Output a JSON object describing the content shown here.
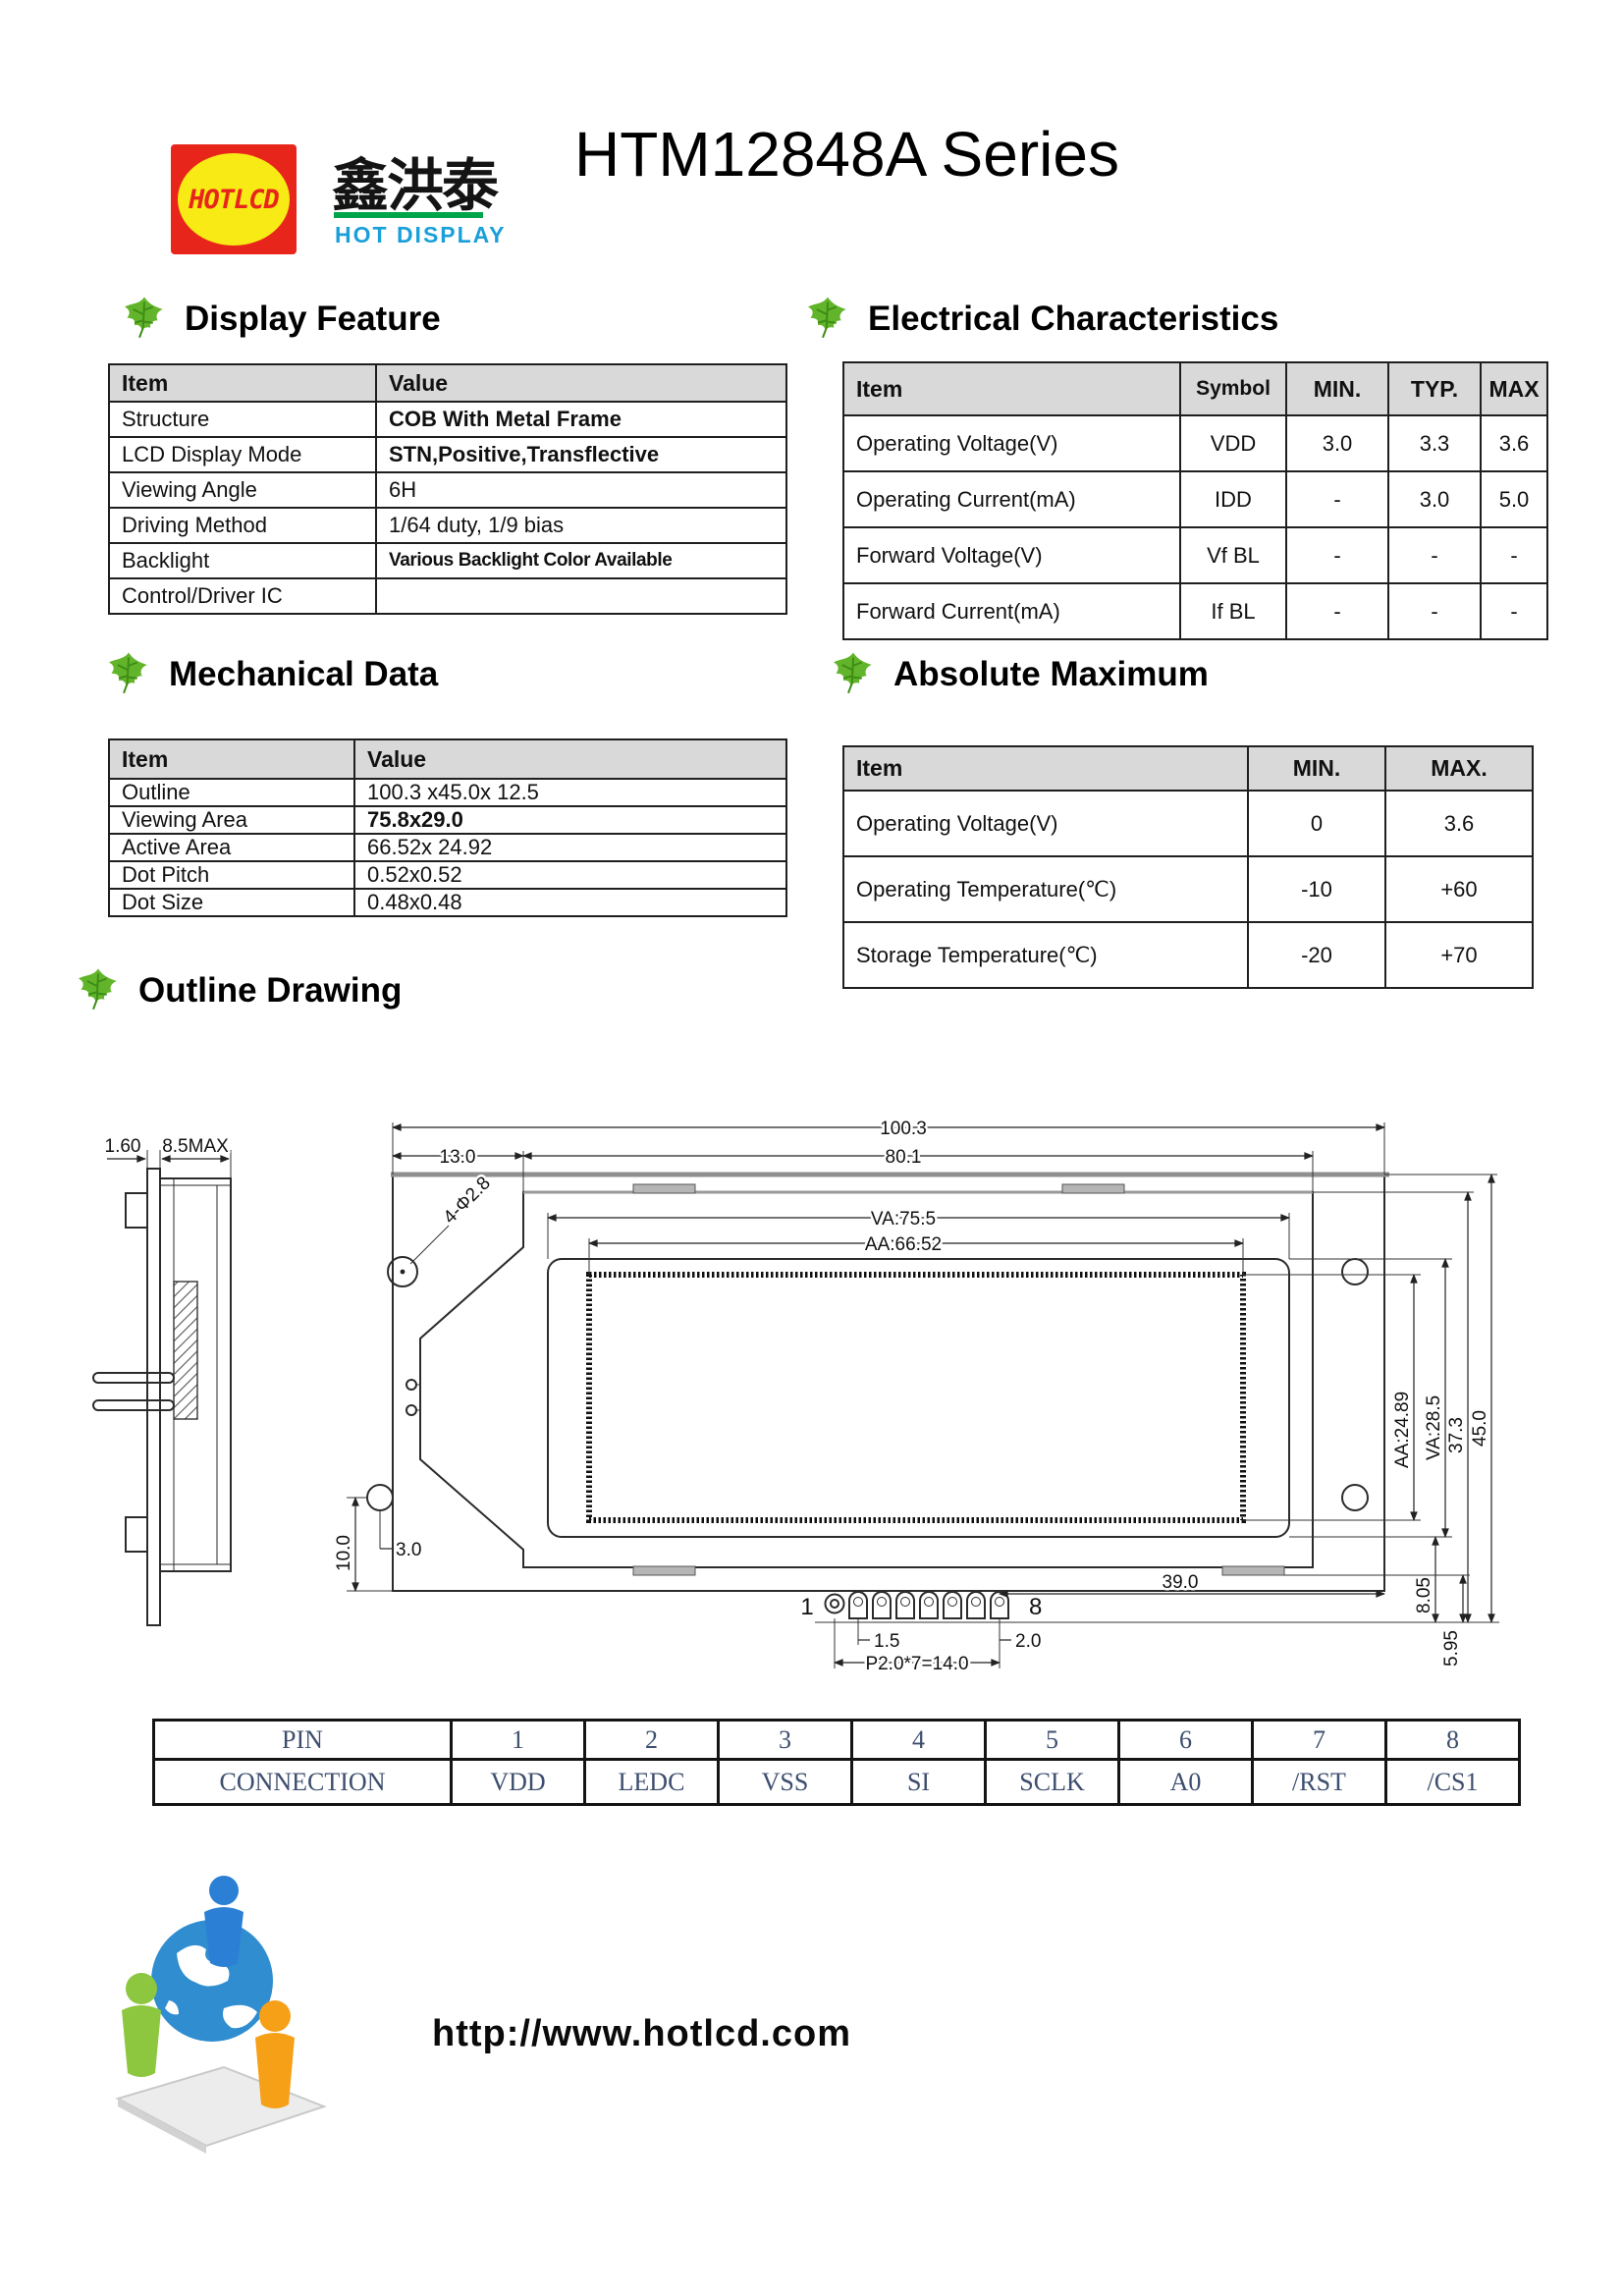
{
  "header": {
    "logo": {
      "text": "HOTLCD",
      "cn": "鑫洪泰",
      "subtitle": "HOT DISPLAY"
    },
    "title": "HTM12848A Series"
  },
  "sections": {
    "display_feature": {
      "title": "Display Feature",
      "columns": [
        "Item",
        "Value"
      ],
      "rows": [
        [
          "Structure",
          "COB With Metal Frame"
        ],
        [
          "LCD Display Mode",
          "STN,Positive,Transflective"
        ],
        [
          "Viewing Angle",
          "6H"
        ],
        [
          "Driving Method",
          "1/64 duty, 1/9 bias"
        ],
        [
          "Backlight",
          "Various Backlight Color Available"
        ],
        [
          "Control/Driver IC",
          ""
        ]
      ]
    },
    "electrical": {
      "title": "Electrical Characteristics",
      "columns": [
        "Item",
        "Symbol",
        "MIN.",
        "TYP.",
        "MAX"
      ],
      "rows": [
        [
          "Operating Voltage(V)",
          "VDD",
          "3.0",
          "3.3",
          "3.6"
        ],
        [
          "Operating Current(mA)",
          "IDD",
          "-",
          "3.0",
          "5.0"
        ],
        [
          "Forward Voltage(V)",
          "Vf BL",
          "-",
          "-",
          "-"
        ],
        [
          "Forward Current(mA)",
          "If BL",
          "-",
          "-",
          "-"
        ]
      ]
    },
    "mechanical": {
      "title": "Mechanical Data",
      "columns": [
        "Item",
        "Value"
      ],
      "rows": [
        [
          "Outline",
          "100.3 x45.0x 12.5"
        ],
        [
          "Viewing Area",
          "75.8x29.0"
        ],
        [
          "Active Area",
          "66.52x 24.92"
        ],
        [
          "Dot Pitch",
          "0.52x0.52"
        ],
        [
          "Dot Size",
          "0.48x0.48"
        ]
      ]
    },
    "absolute_maximum": {
      "title": "Absolute Maximum",
      "columns": [
        "Item",
        "MIN.",
        "MAX."
      ],
      "rows": [
        [
          "Operating Voltage(V)",
          "0",
          "3.6"
        ],
        [
          "Operating Temperature(℃)",
          "-10",
          "+60"
        ],
        [
          "Storage Temperature(℃)",
          "-20",
          "+70"
        ]
      ]
    },
    "outline_drawing": {
      "title": "Outline Drawing"
    }
  },
  "drawing": {
    "width_total": "100.3",
    "width_bezel": "80.1",
    "width_va": "VA:75.5",
    "width_aa": "AA:66.52",
    "offset_left": "13.0",
    "side_thickness": "1.60",
    "side_height": "8.5MAX",
    "holes_note": "4-Φ2.8",
    "height_aa": "AA:24.89",
    "height_va": "VA:28.5",
    "height_37": "37.3",
    "height_total": "45.0",
    "dim_8_05": "8.05",
    "dim_5_95": "5.95",
    "dim_39": "39.0",
    "dim_10": "10.0",
    "dim_3": "3.0",
    "dim_1_5": "1.5",
    "dim_2_0": "2.0",
    "pin_pitch": "P2.0*7=14.0",
    "pin_first": "1",
    "pin_last": "8"
  },
  "pin_table": {
    "rows": [
      [
        "PIN",
        "1",
        "2",
        "3",
        "4",
        "5",
        "6",
        "7",
        "8"
      ],
      [
        "CONNECTION",
        "VDD",
        "LEDC",
        "VSS",
        "SI",
        "SCLK",
        "A0",
        "/RST",
        "/CS1"
      ]
    ]
  },
  "footer": {
    "url": "http://www.hotlcd.com"
  }
}
